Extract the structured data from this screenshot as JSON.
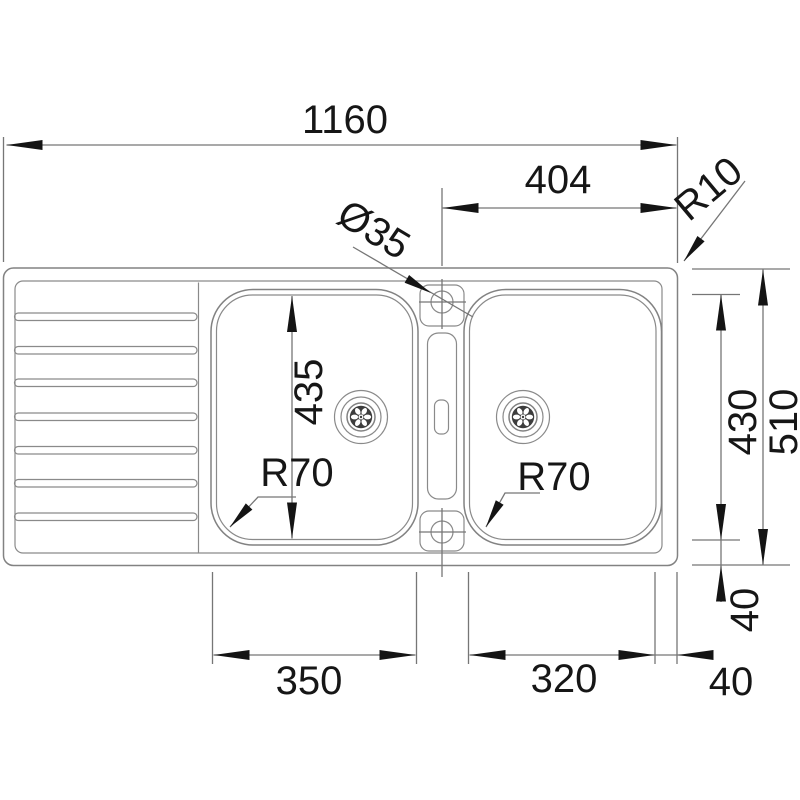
{
  "drawing": {
    "title": "Double bowl inset sink with drainer - dimensioned top view",
    "units": "mm",
    "colors": {
      "background": "#ffffff",
      "line": "#828282",
      "ink": "#141414"
    },
    "features": {
      "bowls": 2,
      "drainer_ridges": 7,
      "tap_holes": 2,
      "drains": 2
    },
    "labels": {
      "overall_width": "1160",
      "right_bowl_offset": "404",
      "outer_corner_radius": "R10",
      "tap_hole_diameter": "Ø35",
      "left_bowl_depth": "435",
      "right_bowl_depth": "430",
      "overall_depth": "510",
      "left_bowl_corner_radius": "R70",
      "right_bowl_corner_radius": "R70",
      "left_bowl_width": "350",
      "right_bowl_width": "320",
      "bottom_edge_gap": "40",
      "right_edge_gap": "40"
    }
  }
}
